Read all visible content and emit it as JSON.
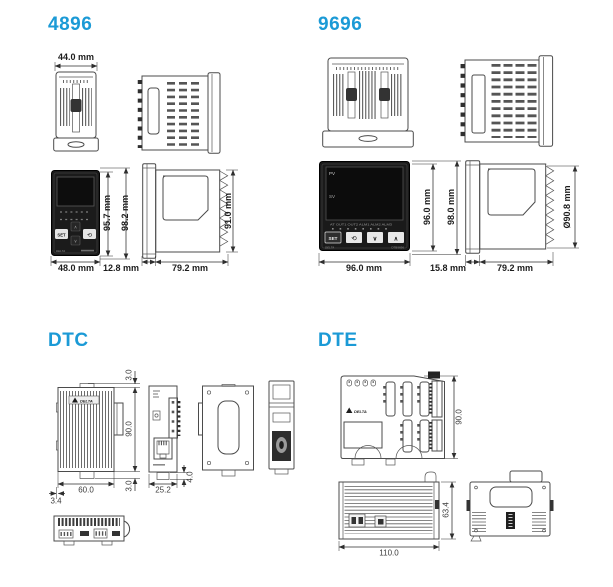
{
  "palette": {
    "accent": "#1B9AD6",
    "line": "#4b4b4b"
  },
  "s4896": {
    "title": "4896",
    "front": {
      "btn_set": "SET",
      "btn_loop": "⟲",
      "btn_up": "∧",
      "btn_down": "∨",
      "brand": "DELTA"
    },
    "dims": {
      "top_width": "44.0 mm",
      "inner_height": "95.7 mm",
      "outer_height": "98.2 mm",
      "front_width": "48.0 mm",
      "bezel_depth": "12.8 mm",
      "body_depth": "79.2 mm",
      "case_height": "91.0 mm"
    }
  },
  "s9696": {
    "title": "9696",
    "front": {
      "pv": "PV",
      "sv": "SV",
      "indicators": "AT OUT1 OUT2 ALM1 ALM2 ALM3",
      "btn_set": "SET",
      "btn_loop": "⟲",
      "btn_down": "∨",
      "btn_up": "∧",
      "brand": "DELTA",
      "model": "DTB9696"
    },
    "dims": {
      "inner_height": "96.0 mm",
      "outer_height": "98.0 mm",
      "front_width": "96.0 mm",
      "bezel_depth": "15.8 mm",
      "body_depth": "79.2 mm",
      "case_height": "Ø90.8 mm"
    }
  },
  "dtc": {
    "title": "DTC",
    "brand": "DELTA",
    "dims": {
      "top_clip": "3.0",
      "height": "90.0",
      "bottom_clip": "3.0",
      "width": "60.0",
      "side_offset": "3.4",
      "depth": "25.2",
      "latch": "4.0"
    }
  },
  "dte": {
    "title": "DTE",
    "brand": "DELTA",
    "dims": {
      "height": "90.0",
      "width": "110.0",
      "depth": "63.4"
    }
  }
}
